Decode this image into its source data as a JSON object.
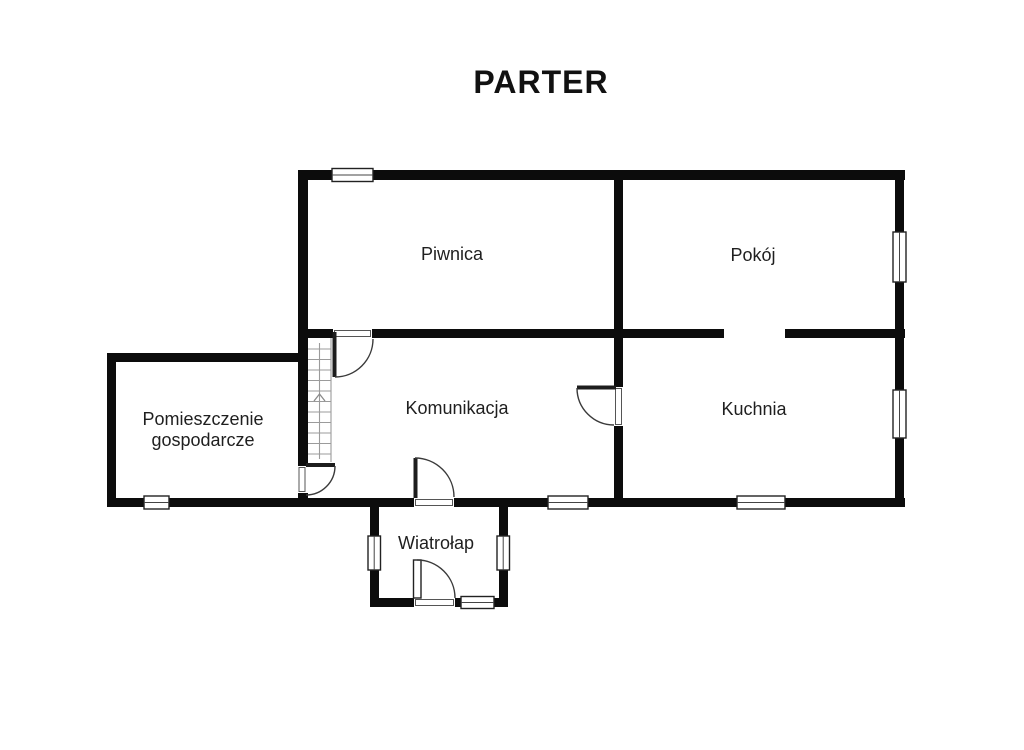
{
  "title": "PARTER",
  "floor_plan": {
    "rooms": {
      "piwnica": {
        "label": "Piwnica"
      },
      "pokoj": {
        "label": "Pokój"
      },
      "pomieszczenie_gospodarcze": {
        "label_line1": "Pomieszczenie",
        "label_line2": "gospodarcze"
      },
      "komunikacja": {
        "label": "Komunikacja"
      },
      "kuchnia": {
        "label": "Kuchnia"
      },
      "wiatrolap": {
        "label": "Wiatrołap"
      }
    },
    "features": {
      "stairs_direction": "up",
      "door_count": 5,
      "window_count": 9
    },
    "colors": {
      "background": "#ffffff",
      "wall": "#0c0c0c",
      "text": "#1f1f1f",
      "stair_line": "#9b9b9b",
      "door_arc": "#3a3a3a"
    }
  }
}
